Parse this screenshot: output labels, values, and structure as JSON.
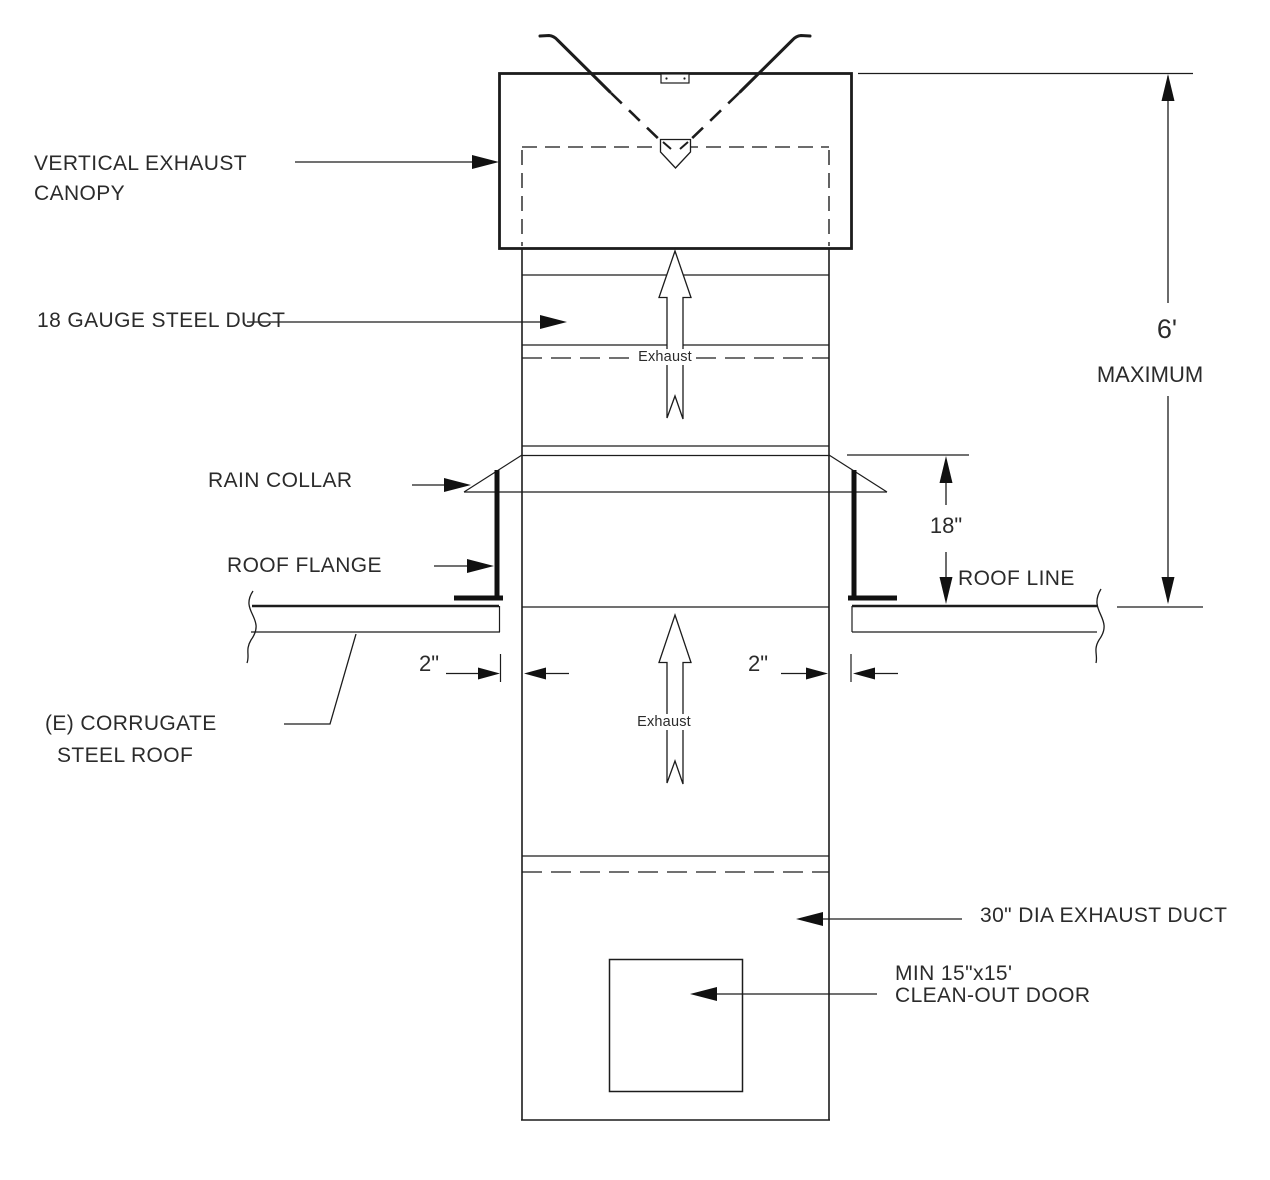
{
  "drawing": {
    "labels": {
      "canopy_line1": "VERTICAL EXHAUST",
      "canopy_line2": "CANOPY",
      "steel_duct": "18 GAUGE STEEL DUCT",
      "rain_collar": "RAIN COLLAR",
      "roof_flange": "ROOF FLANGE",
      "roof_line": "ROOF LINE",
      "corrugate_line1": "(E) CORRUGATE",
      "corrugate_line2": "STEEL ROOF",
      "exhaust_duct": "30\" DIA EXHAUST DUCT",
      "cleanout_line1": "MIN 15\"x15'",
      "cleanout_line2": "CLEAN-OUT DOOR",
      "flow_upper": "Exhaust",
      "flow_lower": "Exhaust"
    },
    "dimensions": {
      "max_height_value": "6'",
      "max_height_qualifier": "MAXIMUM",
      "collar_height": "18\"",
      "clearance_left": "2\"",
      "clearance_right": "2\""
    },
    "colors": {
      "line": "#1c1c1c",
      "text": "#2b2b2b",
      "background": "#ffffff"
    }
  }
}
